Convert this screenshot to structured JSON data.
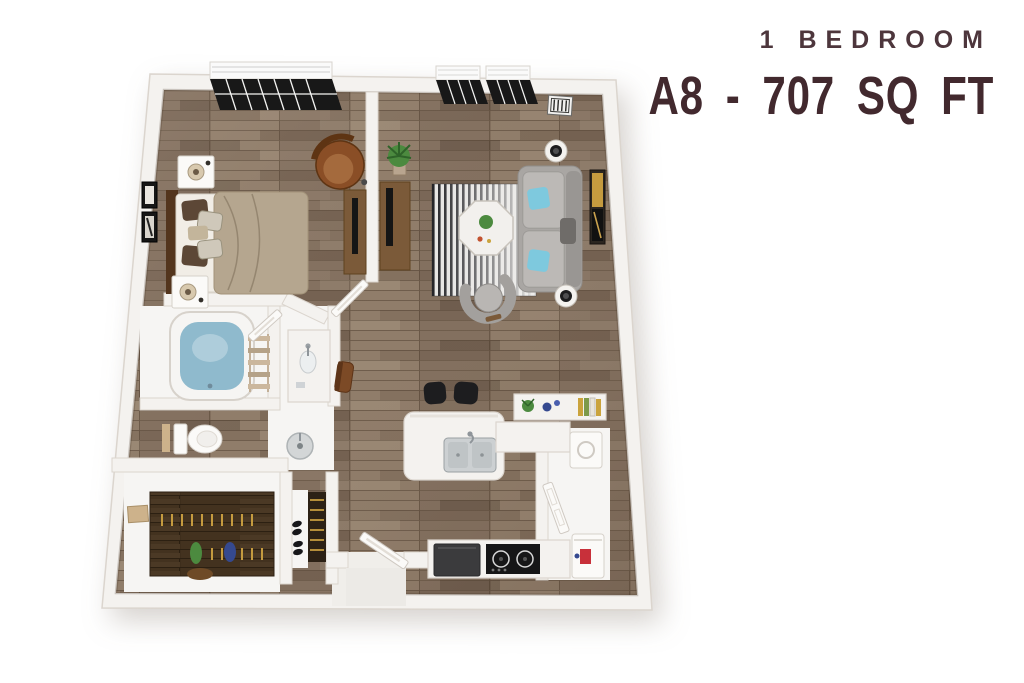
{
  "header": {
    "plan_type": "1 BEDROOM",
    "unit_label": "A8 - 707 SQ FT"
  },
  "palette": {
    "title_accent": "#4d363c",
    "title_main": "#42292e",
    "wall": "#f4f2ef",
    "wall_edge": "#dbd5ce",
    "white_floor": "#f6f5f3",
    "door": "#fbfaf8",
    "floor_base": "#8b7866",
    "floor_dark": "#6b5948",
    "closet_floor": "#43321f",
    "rug_dark": "#232327",
    "rug_light": "#edecea",
    "sofa_gray": "#a9a6a3",
    "sofa_gray_light": "#bcb9b6",
    "accent_teal": "#7ec9de",
    "tub_water": "#8fbacd",
    "leather_brown": "#8a4e26",
    "wood_furniture": "#7b5a39",
    "wood_dark": "#53351d",
    "bed_duvet": "#b5a68f",
    "bed_sheet": "#f1ede6",
    "pillow_brown": "#5c4736",
    "pillow_pattern": "#cfc8ba",
    "appliance_black": "#1d1d1f",
    "appliance_gray": "#3b3b3d",
    "steel": "#c9cdcf",
    "accent_red": "#c8303a",
    "accent_blue": "#35498f",
    "accent_green": "#4c8a3f",
    "accent_gold": "#c59b3f",
    "tan": "#cdb28b"
  },
  "floorplan": {
    "style": "3d-rendered-top-view",
    "rooms": [
      {
        "name": "bedroom",
        "furniture": [
          "bed",
          "nightstands",
          "table-lamps",
          "lounge-chair",
          "tv-console",
          "wall-art",
          "window"
        ]
      },
      {
        "name": "living-room",
        "furniture": [
          "sofa",
          "teal-pillows",
          "barrel-chair",
          "coffee-table",
          "area-rug",
          "side-tables-with-lamps",
          "media-console",
          "plant",
          "wall-art",
          "windows",
          "ceiling-vent"
        ]
      },
      {
        "name": "bathroom",
        "furniture": [
          "bathtub",
          "towel-ladder",
          "toilet",
          "vanity",
          "wash-basin"
        ]
      },
      {
        "name": "walk-in-closet",
        "furniture": [
          "hanging-rods",
          "storage-box",
          "vases"
        ]
      },
      {
        "name": "kitchen",
        "furniture": [
          "peninsula-counter",
          "double-sink",
          "bar-stools",
          "cooktop",
          "refrigerator",
          "counter-decor"
        ]
      },
      {
        "name": "entry",
        "furniture": [
          "entry-door",
          "coat-closet",
          "shoes"
        ]
      },
      {
        "name": "laundry-closet",
        "furniture": [
          "washer",
          "dryer",
          "utility-door"
        ]
      }
    ]
  }
}
